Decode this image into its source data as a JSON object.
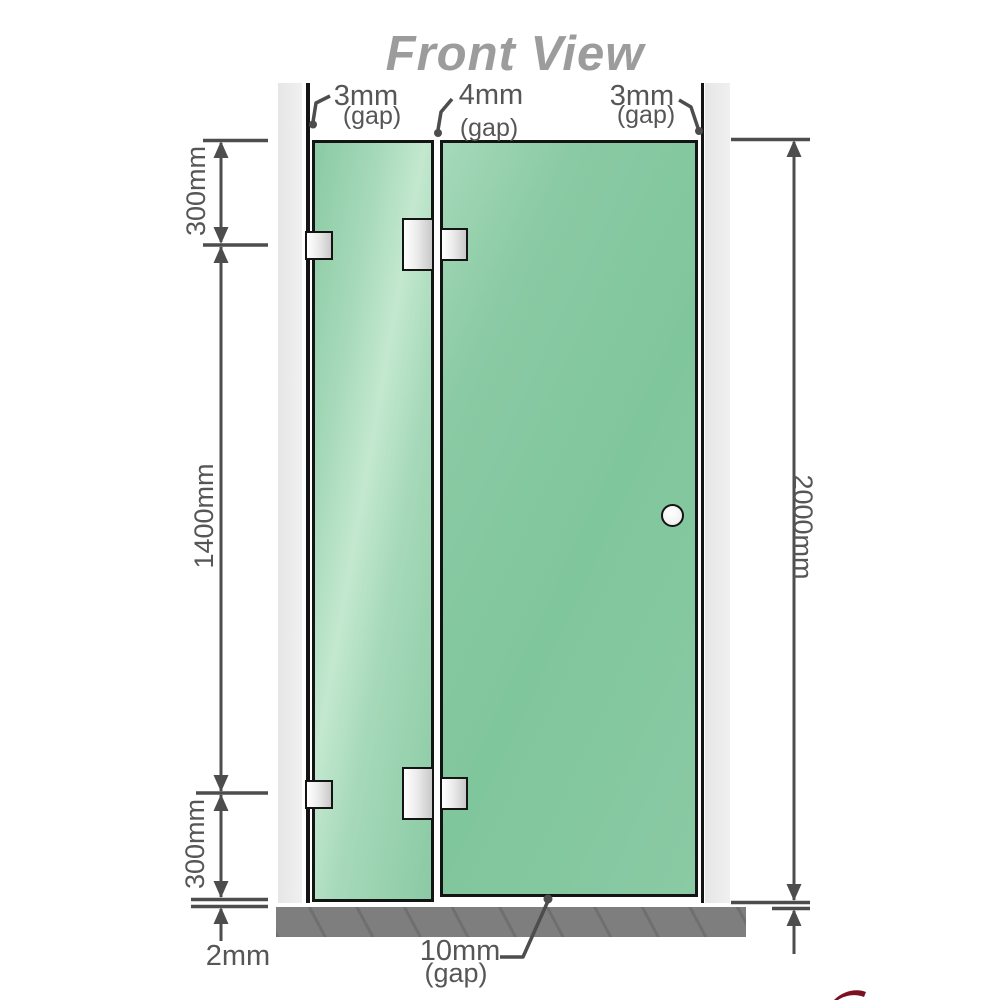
{
  "title": "Front View",
  "gap_labels": {
    "top_left": {
      "value": "3mm",
      "note": "(gap)"
    },
    "top_center": {
      "value": "4mm",
      "note": "(gap)"
    },
    "top_right": {
      "value": "3mm",
      "note": "(gap)"
    },
    "bottom_center": {
      "value": "10mm",
      "note": "(gap)"
    },
    "bottom_left": {
      "value": "2mm"
    }
  },
  "dimensions": {
    "left_upper": "300mm",
    "left_middle": "1400mm",
    "left_lower": "300mm",
    "right_overall": "2000mm"
  },
  "colors": {
    "glass": "#8acaa4",
    "glass_light": "#a6d9b9",
    "glass_highlight": "#c3e8cf",
    "glass_right": "#80c69c",
    "wall": "#eaeaea",
    "outline": "#141414",
    "metal": "#c9c9c9",
    "metal_light": "#ffffff",
    "floor": "#7e7e7e",
    "dimension": "#4d4d4d",
    "text": "#565656",
    "title_text": "#9c9c9c",
    "red_accent": "#7a1222"
  }
}
